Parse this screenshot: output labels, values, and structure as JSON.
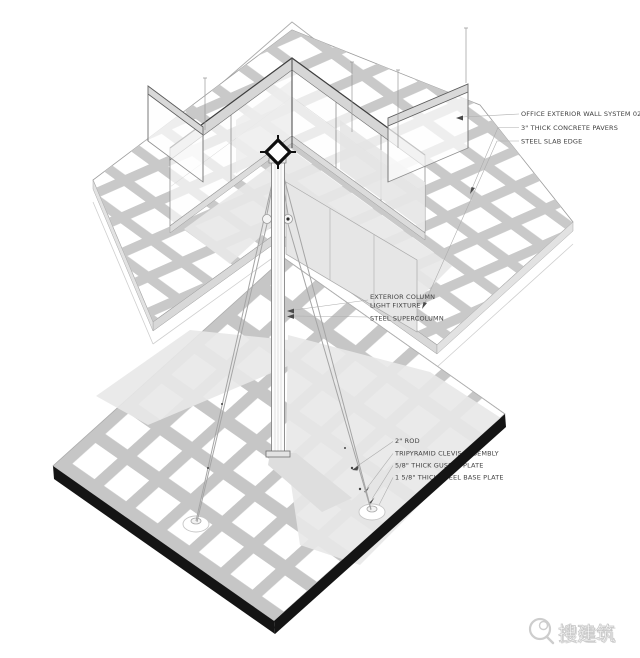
{
  "page": {
    "background": "#ffffff",
    "type": "axonometric construction detail"
  },
  "annotations": {
    "top": {
      "wall_system": "OFFICE EXTERIOR WALL SYSTEM 02",
      "pavers": "3\" THICK CONCRETE PAVERS",
      "slab_edge": "STEEL SLAB EDGE"
    },
    "middle": {
      "exterior_column": "EXTERIOR COLUMN",
      "light_fixture": "LIGHT FIXTURE",
      "supercolumn": "STEEL SUPERCOLUMN"
    },
    "bottom": {
      "rod": "2\" ROD",
      "clevis": "TRIPYRAMID CLEVIS ASSEMBLY",
      "gusset": "5/8\" THICK GUSSET PLATE",
      "base_plate": "1 5/8\" THICK STEEL BASE PLATE"
    }
  },
  "watermark": {
    "text": "搜建筑"
  },
  "colors": {
    "ink": "#3f3f3f",
    "slab_edge_black": "#141414",
    "shadow": "#e8e8e8",
    "line_light": "#c8c8c8",
    "line_mid": "#9a9a9a",
    "parapet_band": "#d6d6d6"
  }
}
